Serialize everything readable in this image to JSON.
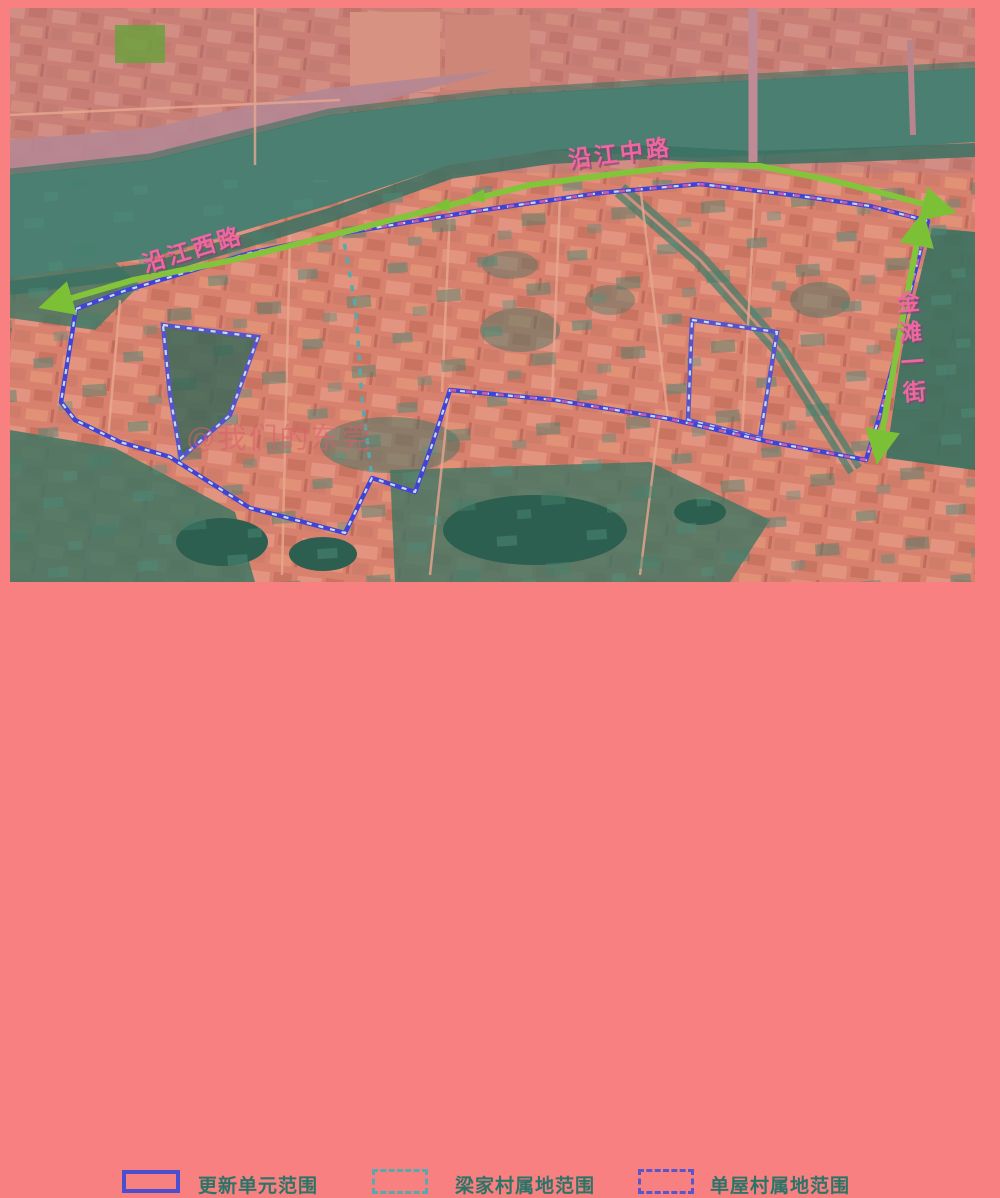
{
  "map": {
    "road_labels": {
      "yanjiang_west": "沿江西路",
      "yanjiang_middle": "沿江中路",
      "jintan_first": "金滩一街"
    },
    "watermark": "@我们的东莞",
    "colors": {
      "frame_pink": "#f98080",
      "urban_salmon": "#d8816e",
      "river_teal": "#4b7f72",
      "vegetation_green": "#3f7663",
      "pond_dark_teal": "#2c5f4f",
      "route_arrow_green": "#84c43b",
      "renewal_boundary_blue": "#4143d8",
      "boundary_dot_light": "#c6dcec",
      "liangjia_dash_teal": "#57aaac",
      "danwu_dot_blue": "#5956c9",
      "road_label_pink": "#f0679f",
      "legend_text_teal": "#2b7467"
    }
  },
  "legend": {
    "items": [
      {
        "label": "更新单元范围",
        "style": "solid-blue"
      },
      {
        "label": "梁家村属地范围",
        "style": "dashed-teal"
      },
      {
        "label": "单屋村属地范围",
        "style": "dotted-blue"
      }
    ]
  }
}
